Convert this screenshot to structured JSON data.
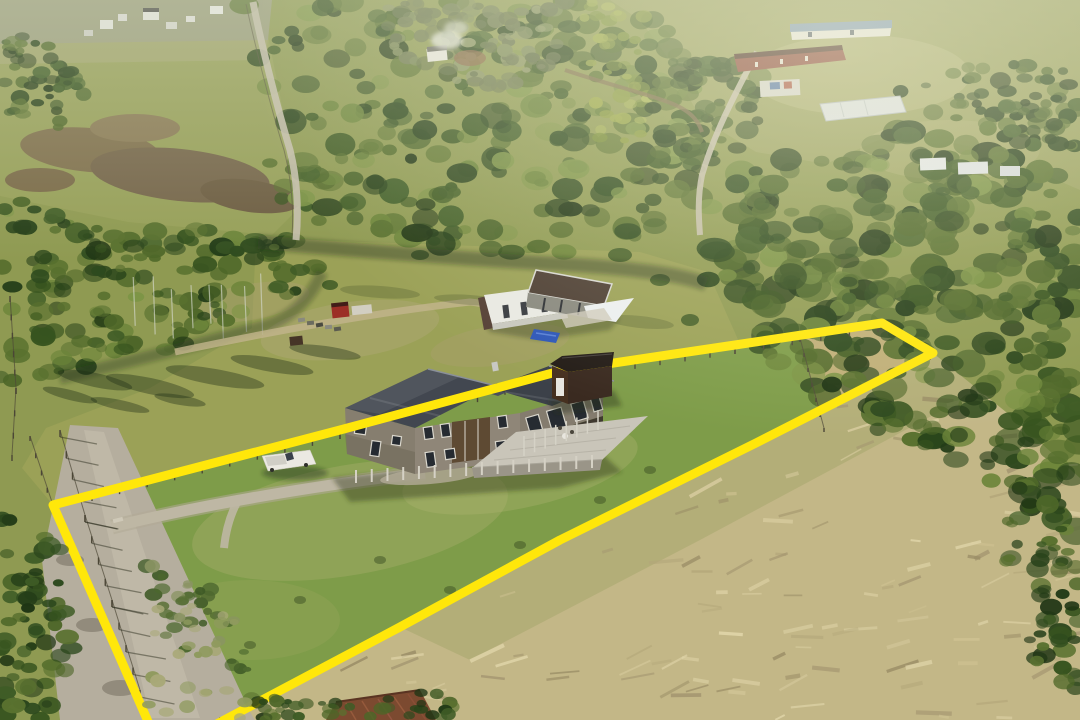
{
  "scene": {
    "type": "aerial-drone-photo",
    "description": "Aerial drone photograph of a rural homestead property outlined with a bright yellow boundary overlay. A weathered two-story timber house with a raised deck sits in a mowed green paddock; tall flattened golden grass fills the lower right; native forest surrounds the clearing; neighbouring houses sit on distant sunlit ridges.",
    "lighting": "low sun with haze washing in from the upper right"
  },
  "boundary": {
    "label": "property-boundary-overlay",
    "color": "#ffe70a",
    "stroke_width": 9,
    "points": "150,726 53,505 340,430 560,371 735,345 882,323 933,353 756,443 560,540 400,627 213,726"
  },
  "palette": {
    "boundary_yellow": "#ffe70a",
    "paddock_green": "#7e9c49",
    "slope_olive": "#9ba157",
    "field_olive": "#97a059",
    "meadow_gold": "#c3b787",
    "apex_gold": "#bfae77",
    "forest_dark": "#2e4a1e",
    "roof_dark": "#424750",
    "roof_dark_right": "#3c4149",
    "house_wall": "#8f8678",
    "house_wall_shade": "#867e6f",
    "deck_gray": "#c9c5b9",
    "shed_brown": "#46301f",
    "shed_roof": "#241d18",
    "tarp_blue": "#2e57b8",
    "truck_white": "#ebe9e2",
    "road_gravel": "#b5ae9e",
    "barn_red": "#8a4538",
    "blue_roof": "#7e9ab8",
    "rust_roof": "#7c4a30",
    "neighbor_white": "#e9e9e3",
    "neighbor_roof": "#4f4136"
  },
  "objects": [
    {
      "id": "main-house",
      "label": "two-story weathered wood house with dark metal roof",
      "x": 470,
      "y": 425
    },
    {
      "id": "rear-deck",
      "label": "raised timber deck on posts",
      "x": 560,
      "y": 440
    },
    {
      "id": "storage-shed",
      "label": "dark brown shed with white door",
      "x": 582,
      "y": 381
    },
    {
      "id": "neighbor-house",
      "label": "single-story white house with dark flat roof and awning",
      "x": 560,
      "y": 300
    },
    {
      "id": "blue-tarp",
      "label": "blue tarp on lawn",
      "x": 546,
      "y": 336
    },
    {
      "id": "white-pickup",
      "label": "white pickup truck on driveway",
      "x": 290,
      "y": 462
    },
    {
      "id": "red-truck",
      "label": "red truck, trailer and equipment near tree line",
      "x": 340,
      "y": 316
    },
    {
      "id": "gravel-road",
      "label": "gravel road along left edge",
      "x": 110,
      "y": 600
    },
    {
      "id": "driveway",
      "label": "gravel driveway from road to house",
      "x": 270,
      "y": 495
    },
    {
      "id": "green-paddock",
      "label": "mowed green paddock inside boundary",
      "x": 350,
      "y": 560
    },
    {
      "id": "golden-meadow",
      "label": "tall flattened golden grass meadow",
      "x": 750,
      "y": 580
    },
    {
      "id": "forest",
      "label": "surrounding native forest and scrub",
      "x": 880,
      "y": 300
    },
    {
      "id": "distant-houses",
      "label": "distant houses on ridge",
      "x": 160,
      "y": 20
    },
    {
      "id": "blue-roof-house",
      "label": "white house with blue roof on far hill",
      "x": 840,
      "y": 28
    },
    {
      "id": "red-barn",
      "label": "long red farm building",
      "x": 790,
      "y": 60
    },
    {
      "id": "greenhouse",
      "label": "long white greenhouse",
      "x": 862,
      "y": 108
    },
    {
      "id": "rusty-shed",
      "label": "rusty corrugated roof at bottom edge",
      "x": 380,
      "y": 708
    },
    {
      "id": "chimney-smoke",
      "label": "smoke above cottage in forest clearing",
      "x": 448,
      "y": 38
    }
  ]
}
